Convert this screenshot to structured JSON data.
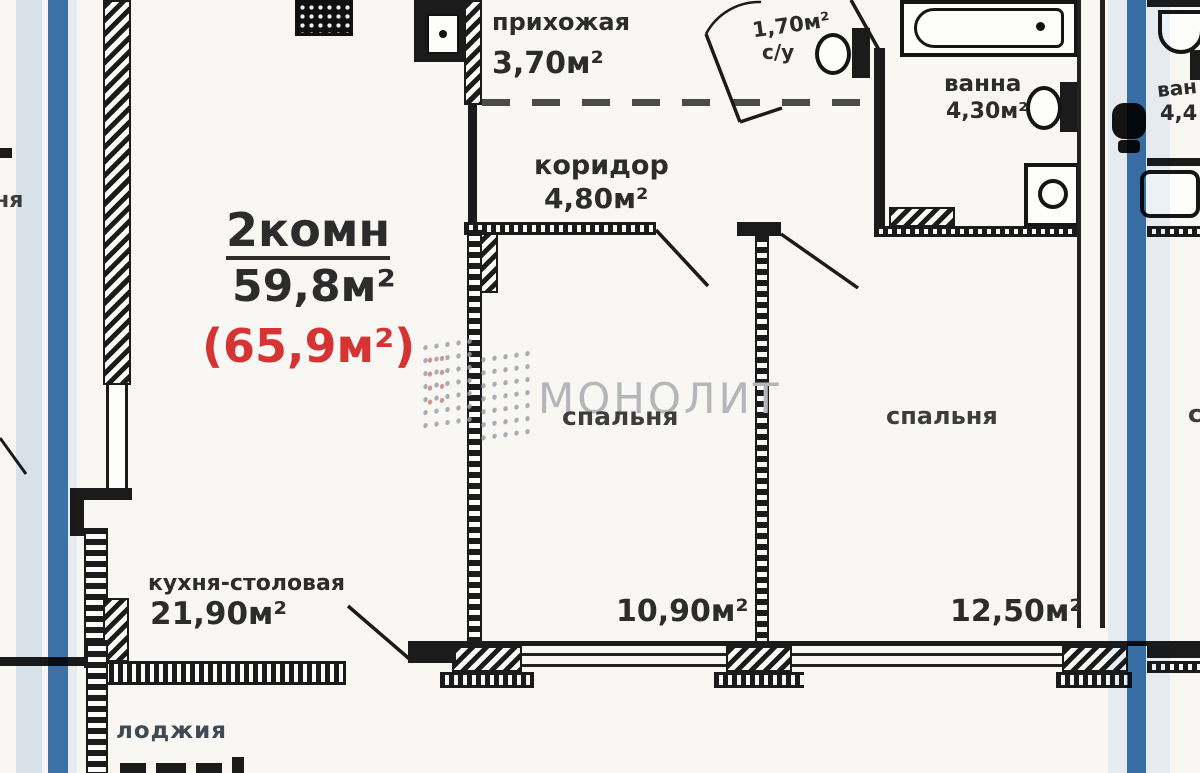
{
  "unit": {
    "type": "2комн",
    "living_area": "59,8м²",
    "total_area": "(65,9м²)"
  },
  "rooms": {
    "hallway": {
      "name": "прихожая",
      "area": "3,70м²"
    },
    "wc": {
      "name": "с/у",
      "area": "1,70м²"
    },
    "bath": {
      "name": "ванна",
      "area": "4,30м²"
    },
    "corridor": {
      "name": "коридор",
      "area": "4,80м²"
    },
    "bedroom1": {
      "name": "спальня",
      "area": "10,90м²"
    },
    "bedroom2": {
      "name": "спальня",
      "area": "12,50м²"
    },
    "kitchen": {
      "name": "кухня-столовая",
      "area": "21,90м²"
    },
    "loggia": {
      "name": "лоджия"
    }
  },
  "watermark": "МОНОЛИТ",
  "adjacent": {
    "left_room_partial": "ня",
    "right_bath_name_partial": "ван",
    "right_bath_area_partial": "4,4",
    "right_bedroom_partial": "сп"
  },
  "colors": {
    "accent_stripe": "#3d76ae",
    "stripe_halo": "#dfe9f5",
    "total_area_red": "#d63333",
    "watermark_gray": "#b4b6b9",
    "wall_black": "#1b1b1b"
  }
}
